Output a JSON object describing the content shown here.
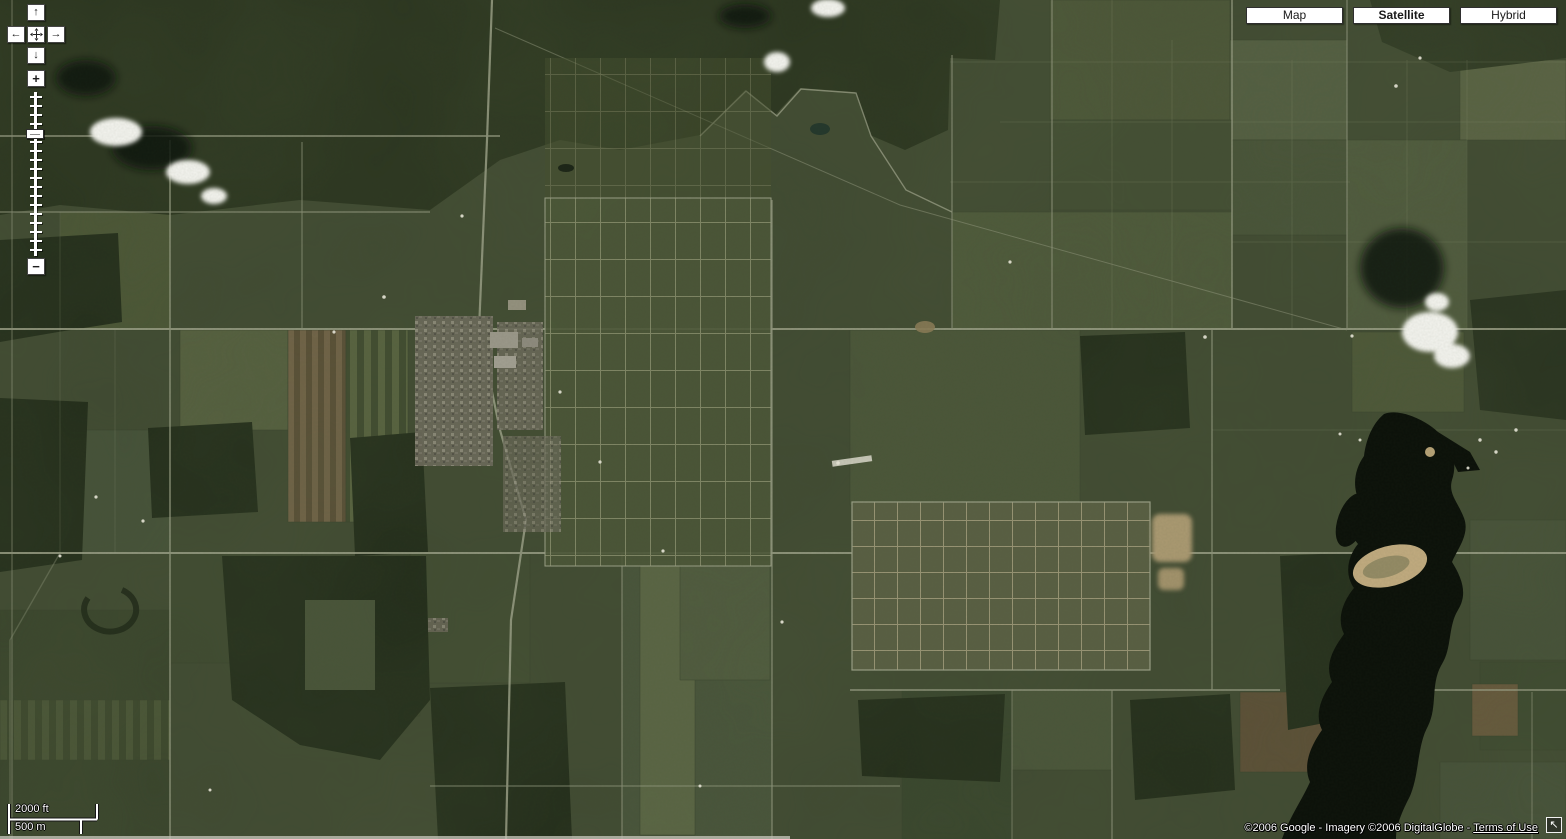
{
  "map_types": [
    {
      "label": "Map",
      "selected": false
    },
    {
      "label": "Satellite",
      "selected": true
    },
    {
      "label": "Hybrid",
      "selected": false
    }
  ],
  "pan_control": {
    "up_icon": "↑",
    "down_icon": "↓",
    "left_icon": "←",
    "right_icon": "→"
  },
  "zoom_control": {
    "zoom_in_icon": "+",
    "zoom_out_icon": "−"
  },
  "scale_bar": {
    "imperial_label": "2000 ft",
    "metric_label": "500 m"
  },
  "attribution": {
    "text": "©2006 Google - Imagery ©2006 DigitalGlobe - ",
    "terms_of_use": "Terms of Use",
    "collapse_icon": "↖"
  },
  "colors": {
    "map_base_green": "#414b33",
    "forest_green": "#273120",
    "water_dark": "#0c110a",
    "road_tan": "#9ba087",
    "sand_tan": "#c3ad81",
    "control_button_bg": "#ffffff",
    "control_button_border": "#454545",
    "attribution_text": "#ffffff"
  }
}
